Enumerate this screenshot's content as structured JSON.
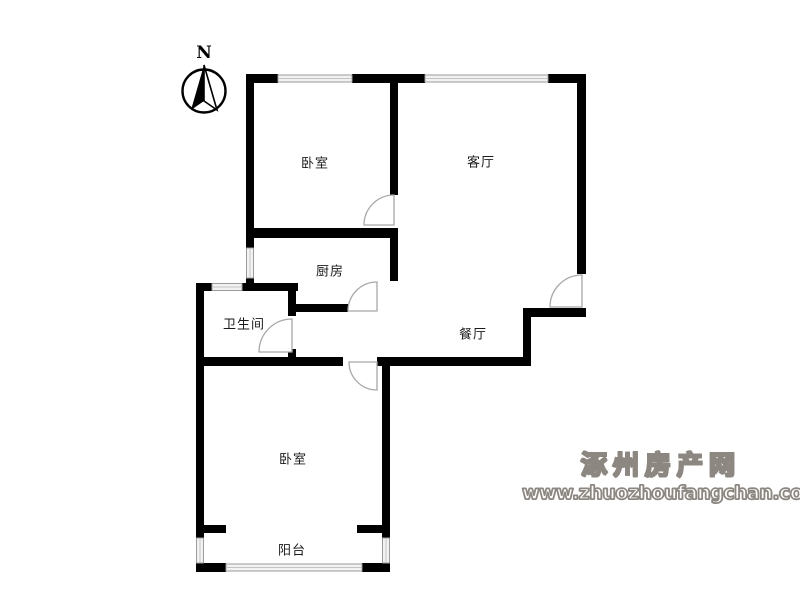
{
  "compass": {
    "north_label": "N"
  },
  "rooms": [
    {
      "id": "bedroom-top",
      "label": "卧室"
    },
    {
      "id": "living-room",
      "label": "客厅"
    },
    {
      "id": "kitchen",
      "label": "厨房"
    },
    {
      "id": "bathroom",
      "label": "卫生间"
    },
    {
      "id": "dining-room",
      "label": "餐厅"
    },
    {
      "id": "bedroom-bottom",
      "label": "卧室"
    },
    {
      "id": "balcony",
      "label": "阳台"
    }
  ],
  "watermark": {
    "site_name": "涿州房产网",
    "site_url": "www.zhuozhoufangchan.com"
  },
  "icons": [
    "north-arrow-icon"
  ],
  "colors": {
    "wall": "#000000",
    "window_line": "#9a9a9a",
    "window_fill": "#f2f2f2",
    "door_arc": "#a8a8a8",
    "label_text": "#1a1a1a",
    "watermark_gray": "#8d8781",
    "background": "#ffffff"
  }
}
